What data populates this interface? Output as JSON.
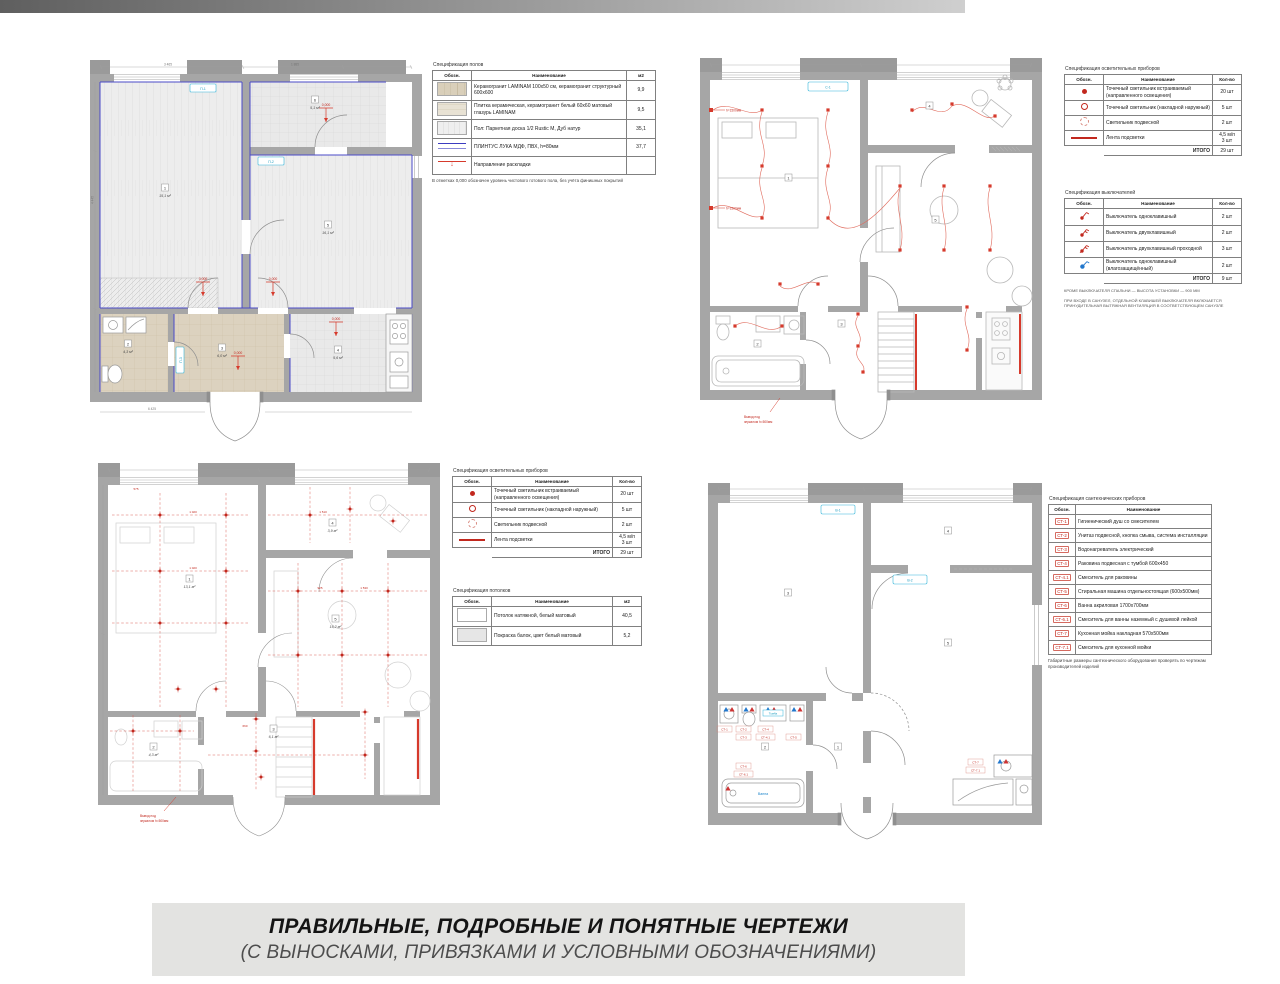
{
  "caption": {
    "line1": "ПРАВИЛЬНЫЕ, ПОДРОБНЫЕ И ПОНЯТНЫЕ ЧЕРТЕЖИ",
    "line2": "(С ВЫНОСКАМИ, ПРИВЯЗКАМИ И УСЛОВНЫМИ ОБОЗНАЧЕНИЯМИ)"
  },
  "colors": {
    "wall": "#a6a6a6",
    "accent_blue": "#4a4ac8",
    "red": "#d63a2c",
    "cyan": "#35b6d9",
    "beige_tile": "#d9cfba"
  },
  "tables": {
    "floors": {
      "title": "Спецификация полов",
      "headers": [
        "Обозн.",
        "Наименование",
        "м2"
      ],
      "rows": [
        {
          "sym": "tile-beige",
          "name": "Керамогранит LAMINAM 100х50 см, керамогранит структурный 600х600",
          "qty": "9,9"
        },
        {
          "sym": "tile-marble",
          "name": "Плитка керамическая, керамогранит белый 60х60 матовый глазурь LAMINAM",
          "qty": "9,5"
        },
        {
          "sym": "plank",
          "name": "Пол: Паркетная доска 1/2 Rustic М, Дуб натур",
          "qty": "35,1"
        },
        {
          "sym": "skirt",
          "name": "ПЛИНТУС ЛУКА МДФ, ПВХ, h=80мм",
          "qty": "37,7"
        },
        {
          "sym": "thresh",
          "name": "Направление раскладки",
          "qty": ""
        }
      ],
      "note": "В отметках 0,000 обозначен уровень чистового готового пола, без учёта финишных покрытий"
    },
    "lighting": {
      "title": "Спецификация осветительных приборов",
      "headers": [
        "Обозн.",
        "Наименование",
        "Кол-во"
      ],
      "rows": [
        {
          "sym": "dot",
          "name": "Точечный светильник встраиваемый (направленного освещения)",
          "qty": "20 шт"
        },
        {
          "sym": "ring",
          "name": "Точечный светильник (накладной наружный)",
          "qty": "5 шт"
        },
        {
          "sym": "dashc",
          "name": "Светильник подвесной",
          "qty": "2 шт"
        },
        {
          "sym": "strip",
          "name": "Лента подсветки",
          "qty": "4,5 м/п\n3 шт"
        }
      ],
      "total_label": "ИТОГО",
      "total": "29 шт"
    },
    "switches": {
      "title": "Спецификация выключателей",
      "headers": [
        "Обозн.",
        "Наименование",
        "Кол-во"
      ],
      "rows": [
        {
          "sym": "sw1",
          "name": "Выключатель одноклавишный",
          "qty": "2 шт"
        },
        {
          "sym": "sw2",
          "name": "Выключатель двухклавишный",
          "qty": "2 шт"
        },
        {
          "sym": "sw2p",
          "name": "Выключатель двухклавишный проходной",
          "qty": "3 шт"
        },
        {
          "sym": "swwp",
          "name": "Выключатель одноклавишный (влагозащищённый)",
          "qty": "2 шт"
        }
      ],
      "total_label": "ИТОГО",
      "total": "9 шт",
      "notes": [
        "Кроме выключателя спальни — высота установки — 900 мм",
        "При входе в санузел, отдельной клавишей выключателя включается принудительная вытяжная вентиляция в соответствующем санузле"
      ]
    },
    "ceilings": {
      "title": "Спецификация потолков",
      "headers": [
        "Обозн.",
        "Наименование",
        "м2"
      ],
      "rows": [
        {
          "sym": "blank",
          "name": "Потолок натяжной, белый матовый",
          "qty": "40,5"
        },
        {
          "sym": "paint",
          "name": "Покраска балок, цвет белый матовый",
          "qty": "5,2"
        }
      ]
    },
    "plumbing": {
      "title": "Спецификация сантехнических приборов",
      "headers": [
        "Обозн.",
        "Наименование"
      ],
      "rows": [
        {
          "code": "СТ-1",
          "name": "Гигиенический душ со смесителем"
        },
        {
          "code": "СТ-2",
          "name": "Унитаз подвесной, кнопка смыва, система инсталляции"
        },
        {
          "code": "СТ-3",
          "name": "Водонагреватель электрический"
        },
        {
          "code": "СТ-4",
          "name": "Раковина подвесная с тумбой 600х450"
        },
        {
          "code": "СТ-4.1",
          "name": "Смеситель для раковины"
        },
        {
          "code": "СТ-5",
          "name": "Стиральная машина отдельностоящая (600х500мм)"
        },
        {
          "code": "СТ-6",
          "name": "Ванна акриловая 1700х700мм"
        },
        {
          "code": "СТ-6.1",
          "name": "Смеситель для ванны наземный с душевой лейкой"
        },
        {
          "code": "СТ-7",
          "name": "Кухонная мойка накладная 570х500мм"
        },
        {
          "code": "СТ-7.1",
          "name": "Смеситель для кухонной мойки"
        }
      ],
      "note": "Габаритные размеры сантехнического оборудования проверять по чертежам производителей изделий"
    }
  },
  "plans": {
    "plan1": {
      "rooms": [
        {
          "num": "1",
          "area": "15,1 м²"
        },
        {
          "num": "5",
          "area": "16,1 м²"
        },
        {
          "num": "6",
          "area": "5,1 м²"
        },
        {
          "num": "2",
          "area": "4,3 м²"
        },
        {
          "num": "3",
          "area": "6,0 м²"
        },
        {
          "num": "4",
          "area": "5,6 м²"
        }
      ],
      "labels": {
        "elev": "0,000"
      },
      "tags": [
        "П-1",
        "П-2",
        "П-3"
      ],
      "dims": [
        "3 465",
        "1 885",
        "4 445",
        "6 425"
      ]
    },
    "plan2": {
      "rooms": [
        {
          "num": "1"
        },
        {
          "num": "4"
        },
        {
          "num": "5"
        },
        {
          "num": "2"
        },
        {
          "num": "3"
        }
      ],
      "labels": {
        "sconce": "h=1500мм",
        "mirror1": "Вывод под",
        "mirror2": "зеркалом h=500мм",
        "tag": "С-1"
      }
    },
    "plan3": {
      "rooms": [
        {
          "num": "1",
          "area": "13,1 м²"
        },
        {
          "num": "4",
          "area": "3,9 м²"
        },
        {
          "num": "5",
          "area": "16,2 м²"
        },
        {
          "num": "2",
          "area": "4,3 м²"
        },
        {
          "num": "3",
          "area": "6,1 м²"
        }
      ],
      "labels": {
        "mirror1": "Вывод под",
        "mirror2": "зеркалом h=500мм"
      },
      "dims": [
        "575",
        "1 020",
        "1 020",
        "925",
        "1 510",
        "1 530",
        "660"
      ]
    },
    "plan4": {
      "rooms": [
        {
          "num": "3"
        },
        {
          "num": "4"
        },
        {
          "num": "5"
        },
        {
          "num": "2"
        },
        {
          "num": "1"
        }
      ],
      "tags": [
        "В-1",
        "В-2"
      ],
      "labels": {
        "bath": "Ванна",
        "cab": "Тумба"
      },
      "codes": [
        "СТ-1",
        "СТ-2",
        "СТ-3",
        "СТ-4",
        "СТ-4.1",
        "СТ-5",
        "СТ-6",
        "СТ-6.1",
        "СТ-7",
        "СТ-7.1"
      ]
    }
  }
}
